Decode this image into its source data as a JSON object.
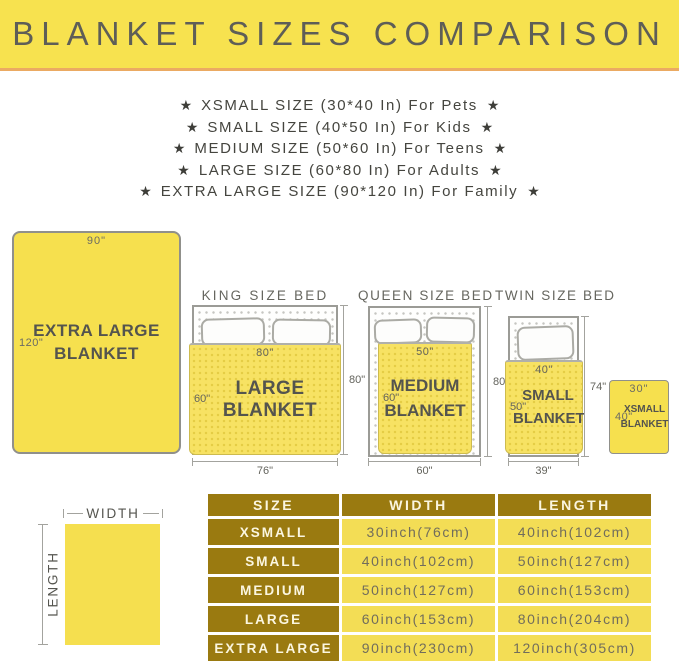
{
  "banner": {
    "title": "BLANKET SIZES COMPARISON"
  },
  "size_list": {
    "star": "★",
    "items": [
      "XSMALL SIZE (30*40 In) For Pets",
      "SMALL SIZE (40*50 In) For Kids",
      "MEDIUM SIZE (50*60 In) For Teens",
      "LARGE SIZE (60*80 In) For Adults",
      "EXTRA LARGE SIZE (90*120 In) For Family"
    ]
  },
  "diagram": {
    "extra_large": {
      "name": "EXTRA LARGE BLANKET",
      "width_label": "90\"",
      "length_label": "120\""
    },
    "king": {
      "title": "KING SIZE BED",
      "blanket_name": "LARGE BLANKET",
      "blanket_width": "80\"",
      "blanket_length": "60\"",
      "bed_width": "76\"",
      "bed_height": "80\""
    },
    "queen": {
      "title": "QUEEN SIZE BED",
      "blanket_name": "MEDIUM BLANKET",
      "blanket_width": "50\"",
      "blanket_length": "60\"",
      "bed_width": "60\"",
      "bed_height": "80\""
    },
    "twin": {
      "title": "TWIN SIZE BED",
      "blanket_name": "SMALL BLANKET",
      "blanket_width": "40\"",
      "blanket_length": "50\"",
      "bed_width": "39\"",
      "bed_height": "74\""
    },
    "xsmall": {
      "name": "XSMALL BLANKET",
      "width_label": "30\"",
      "length_label": "40\""
    }
  },
  "legend": {
    "width": "WIDTH",
    "length": "LENGTH"
  },
  "table": {
    "headers": [
      "SIZE",
      "WIDTH",
      "LENGTH"
    ],
    "rows": [
      [
        "XSMALL",
        "30inch(76cm)",
        "40inch(102cm)"
      ],
      [
        "SMALL",
        "40inch(102cm)",
        "50inch(127cm)"
      ],
      [
        "MEDIUM",
        "50inch(127cm)",
        "60inch(153cm)"
      ],
      [
        "LARGE",
        "60inch(153cm)",
        "80inch(204cm)"
      ],
      [
        "EXTRA LARGE",
        "90inch(230cm)",
        "120inch(305cm)"
      ]
    ]
  },
  "colors": {
    "banner_yellow": "#F7E24F",
    "banner_underline": "#EBAA62",
    "blanket_yellow": "#F6E04E",
    "blanket_texture_dot": "#E5CD45",
    "bed_border_gray": "#9B9B96",
    "table_header_bg": "#9A7A10",
    "table_cell_bg": "#F3DD55",
    "title_gray": "#5E5E57"
  }
}
